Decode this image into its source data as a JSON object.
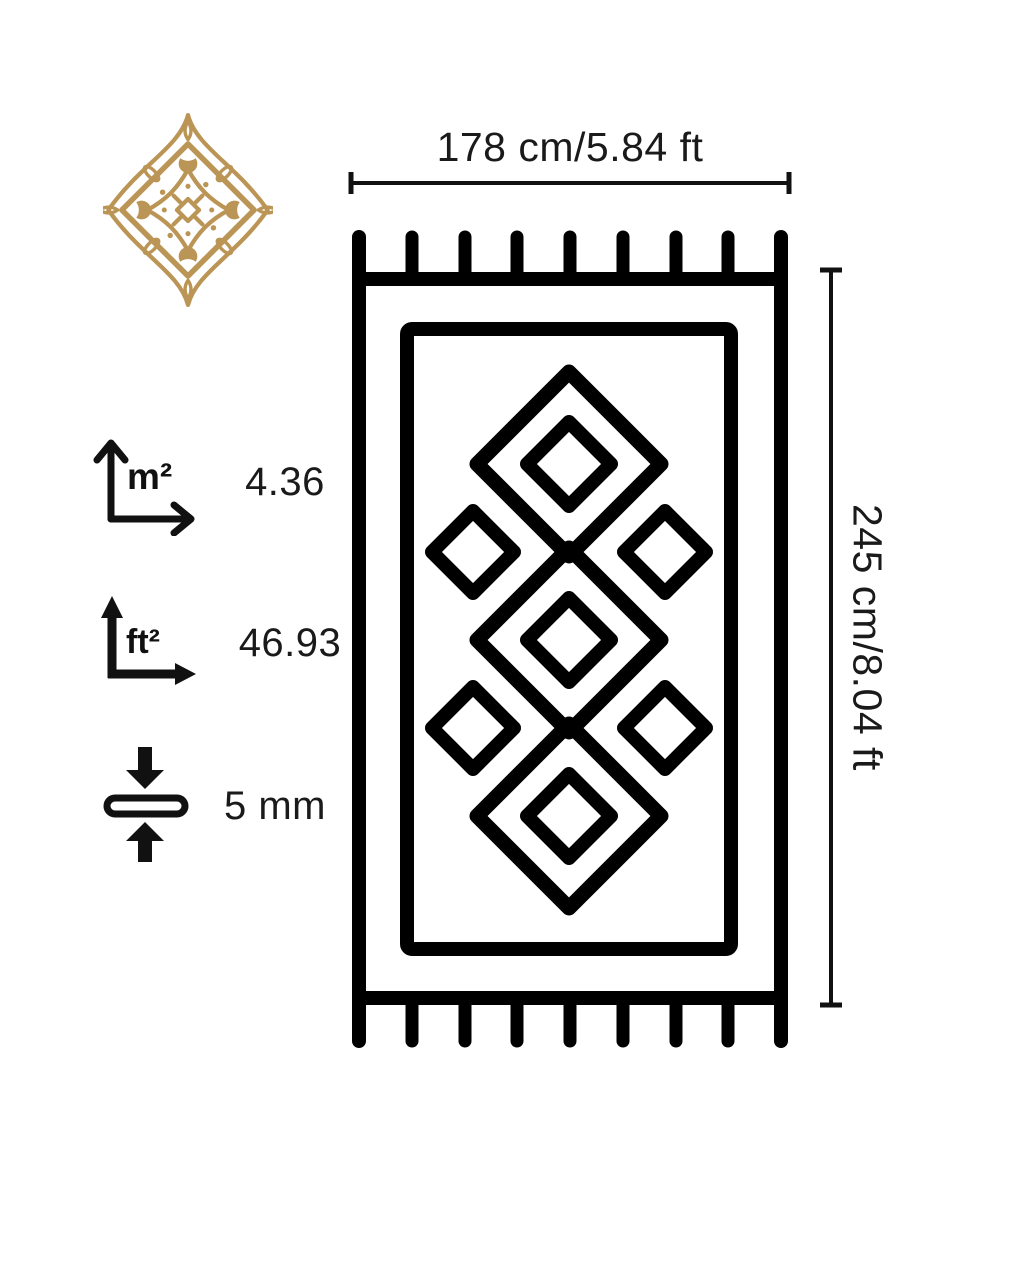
{
  "canvas": {
    "background": "#ffffff"
  },
  "colors": {
    "line": "#000000",
    "text": "#1a1a1a",
    "gold": "#b9914f"
  },
  "ornament": {
    "icon": "arabesque-medallion-icon"
  },
  "width_dimension": {
    "label": "178 cm/5.84 ft"
  },
  "height_dimension": {
    "label": "245 cm/8.04 ft"
  },
  "specs": {
    "area_m2": {
      "unit": "m²",
      "value": "4.36"
    },
    "area_ft2": {
      "unit": "ft²",
      "value": "46.93"
    },
    "thickness": {
      "value": "5 mm"
    }
  },
  "rug": {
    "fringe_tassels_per_side": 9,
    "large_diamonds": 3,
    "inner_diamonds": 3,
    "side_diamonds": 4
  }
}
